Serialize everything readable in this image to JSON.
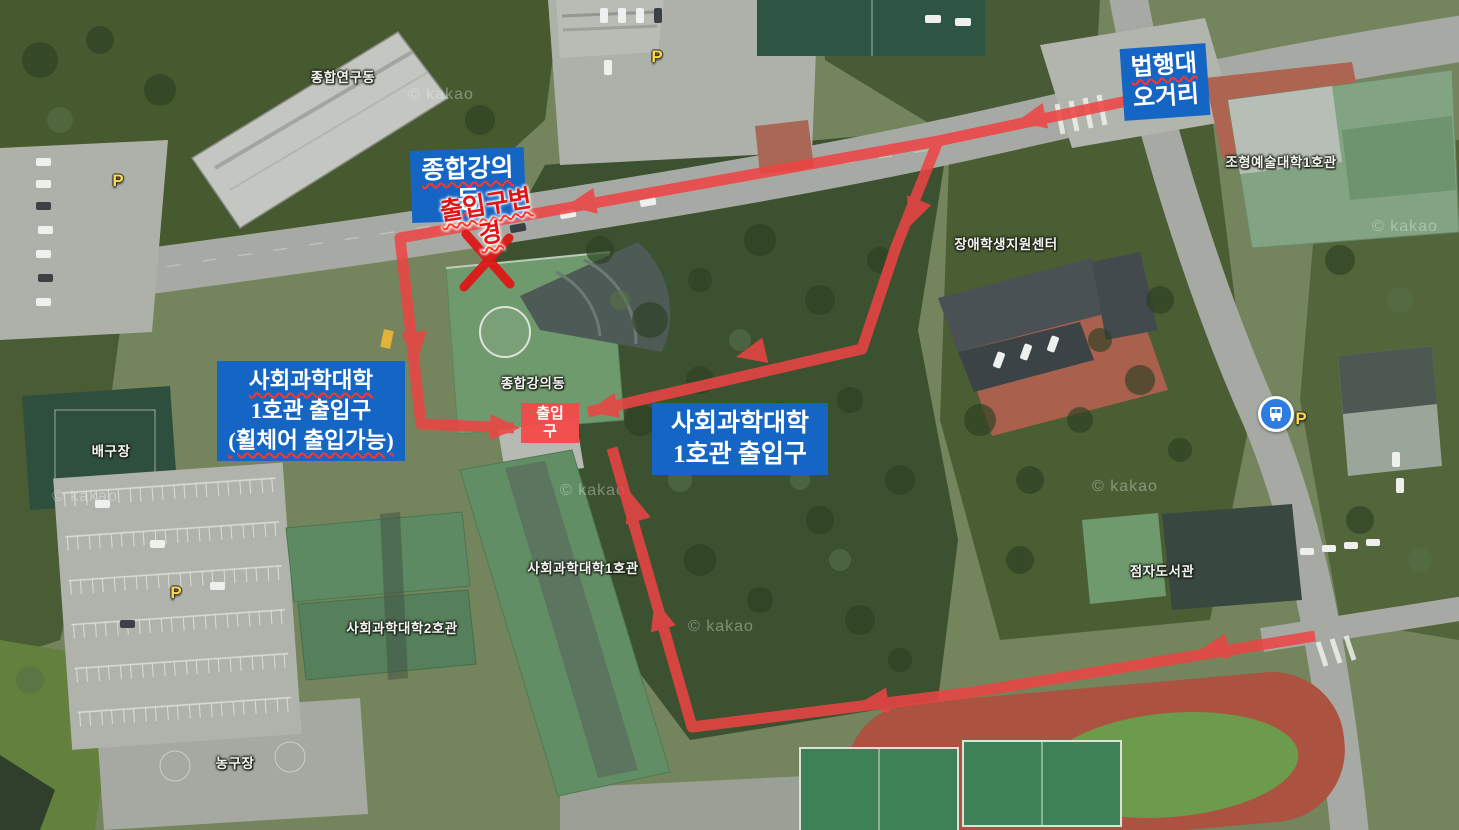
{
  "map": {
    "attribution": "© kakao",
    "parking_symbol": "P",
    "building_labels": [
      "종합연구동",
      "조형예술대학1호관",
      "장애학생지원센터",
      "종합강의동",
      "사회과학대학1호관",
      "사회과학대학2호관",
      "배구장",
      "농구장",
      "점자도서관"
    ]
  },
  "annotations": {
    "colors": {
      "callout_bg": "#1565c5",
      "route_red": "#ee4343",
      "warning_red": "#e31414",
      "parking_yellow": "#ffd84f"
    },
    "callouts": {
      "beophaengdae_ogeori": {
        "line1": "법행대",
        "line2": "오거리"
      },
      "jonghap_gangui_dong": {
        "line1": "종합강의",
        "line2": "동"
      },
      "entrance_wheelchair": {
        "line1": "사회과학대학",
        "line2": "1호관 출입구",
        "line3": "(휠체어 출입가능)"
      },
      "entrance_main": {
        "line1": "사회과학대학",
        "line2": "1호관 출입구"
      }
    },
    "entrance_box": {
      "line1": "출입",
      "line2": "구"
    },
    "entrance_changed": {
      "line1": "출입구변",
      "line2": "경"
    }
  }
}
